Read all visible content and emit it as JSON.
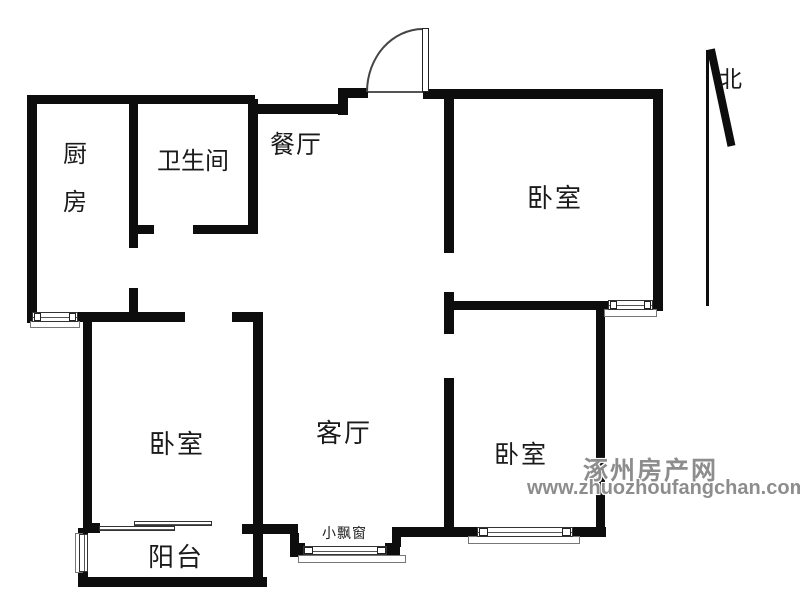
{
  "labels": {
    "kitchen": "厨房",
    "bathroom": "卫生间",
    "dining": "餐厅",
    "bedroom_north": "卧室",
    "bedroom_west": "卧室",
    "bedroom_south": "卧室",
    "living_room": "客厅",
    "balcony": "阳台",
    "bay_window": "小飘窗",
    "north": "北"
  },
  "watermark": {
    "site_name": "涿州房产网",
    "site_url": "www.zhuozhoufangchan.com"
  },
  "colors": {
    "wall": "#0d0d0d",
    "thin_line": "#555555",
    "watermark_gray": "#8d8d8d",
    "background": "#ffffff"
  }
}
